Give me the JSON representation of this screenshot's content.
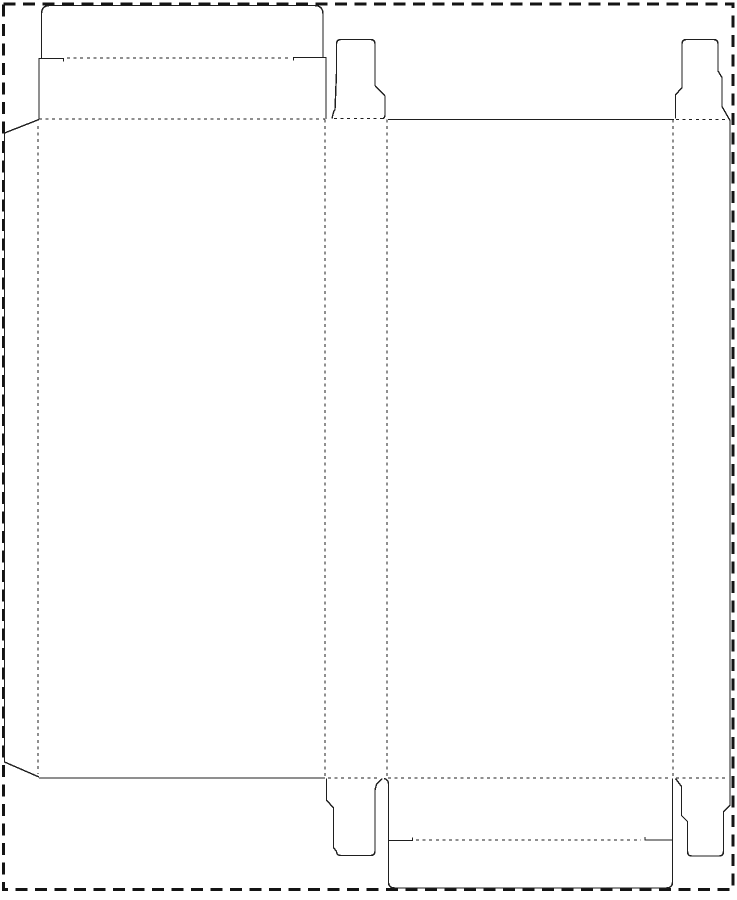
{
  "document": {
    "kind": "packaging-dieline-template",
    "description": "Die-cut template for a reverse tuck end folding carton: glue flap, front panel with tuck-top lid, two side panels with dust-flap tabs (top and bottom), back panel with tuck-bottom flap, inside a dashed cutting-sheet border. No text labels are printed on the drawing.",
    "background_color": "#ffffff"
  },
  "canvas": {
    "width": 737,
    "height": 900
  },
  "styles": {
    "border": {
      "stroke": "#141414",
      "width": 2.6,
      "dash": "12,7.5",
      "meaning": "sheet / bleed boundary"
    },
    "cut": {
      "stroke": "#1f1f1f",
      "width": 1.4,
      "dash": null,
      "meaning": "cut line (solid)"
    },
    "fold": {
      "stroke": "#1f1f1f",
      "width": 1.3,
      "dash": "3,3.6",
      "meaning": "fold / crease line (dashed)"
    }
  },
  "shapes": [
    {
      "name": "sheet-border",
      "style": "border",
      "d": "M3.5,4 H733 V889.5 H3.5 Z"
    },
    {
      "name": "lid-tuck-flap-outline",
      "style": "cut",
      "d": "M41.5,58.5 V14 Q41.5,5.5 50,5.5 L314,5.5 Q323,5.5 323,14 V57.5"
    },
    {
      "name": "lid-left-edge-with-slit",
      "style": "cut",
      "d": "M39,119 V58.5 H63.5 L63.5,61.5"
    },
    {
      "name": "lid-right-edge-with-slit",
      "style": "cut",
      "d": "M326,119 V57.5 H293.5 L293.5,60.5"
    },
    {
      "name": "lid-tuck-crease",
      "style": "fold",
      "d": "M67,58 H291"
    },
    {
      "name": "glue-flap-outline",
      "style": "cut",
      "d": "M39,119.5 L4.5,133 V762 L39,777"
    },
    {
      "name": "glue-flap-crease",
      "style": "fold",
      "d": "M38,126 V774"
    },
    {
      "name": "back-panel-top-cut",
      "style": "cut",
      "d": "M388,119.5 H674"
    },
    {
      "name": "front-panel-bottom-cut",
      "style": "cut",
      "d": "M39,778 H325"
    },
    {
      "name": "dust-tab-top-middle",
      "style": "cut",
      "d": "M332,118.5 Q333.5,111 335,109.5 L336.5,73 V44 Q336.5,39.5 341,39.5 L370.5,39.5 Q375,39.5 375,44 V85.5 L385,96 V115 Q385,117.5 383,118.5"
    },
    {
      "name": "dust-tab-top-right-and-right-edge-and-dust-tab-bottom-right",
      "style": "cut",
      "d": "M675.5,118.5 V95 L682,87.5 V44 Q682,39.5 686.5,39.5 L713.5,39.5 Q718,39.5 718,44 V71 L722,77.5 V106.5 L730,120.5 V805 L723.5,812 V851 Q723.5,856 719,856 L691.5,856 Q687.5,856 687.5,851 V821.5 L681.5,815.5 V786.5 L675.5,778.5"
    },
    {
      "name": "dust-tab-bottom-middle",
      "style": "cut",
      "d": "M326.5,778.5 V800 L333.5,808 V847.5 L336.5,851.5 Q336.5,855.5 341,855.5 L370.5,855.5 Q375,855.5 375,851 V790 L376.5,784.5 L382,778.5"
    },
    {
      "name": "bottom-tuck-flap-outline",
      "style": "cut",
      "d": "M384,778.5 Q388.5,779.5 388.5,784 V882 Q388.5,888 395,888 L665.5,888 Q672.5,888 672.5,882 V778.5"
    },
    {
      "name": "bottom-flap-left-slit",
      "style": "cut",
      "d": "M388.5,840.5 H412.5 V837.5"
    },
    {
      "name": "bottom-flap-right-slit",
      "style": "cut",
      "d": "M672.5,840 H645 V837"
    },
    {
      "name": "bottom-tuck-crease",
      "style": "fold",
      "d": "M416,840 H641"
    },
    {
      "name": "panel-crease-front-left",
      "style": "fold",
      "d": "M325,119.5 V777.5"
    },
    {
      "name": "panel-crease-middle",
      "style": "fold",
      "d": "M387,119.5 V777.5"
    },
    {
      "name": "panel-crease-back-right",
      "style": "fold",
      "d": "M673,119.5 V777.5"
    },
    {
      "name": "top-crease-front-panel",
      "style": "fold",
      "d": "M39,119 H325"
    },
    {
      "name": "top-crease-tab-middle",
      "style": "fold",
      "d": "M334,118.5 H383"
    },
    {
      "name": "top-crease-tab-right",
      "style": "fold",
      "d": "M676,119.5 H729"
    },
    {
      "name": "bottom-crease-tab-middle",
      "style": "fold",
      "d": "M328,778 H381"
    },
    {
      "name": "bottom-crease-back-flap",
      "style": "fold",
      "d": "M388,778 H672"
    },
    {
      "name": "bottom-crease-tab-right",
      "style": "fold",
      "d": "M676,778 H729"
    }
  ]
}
